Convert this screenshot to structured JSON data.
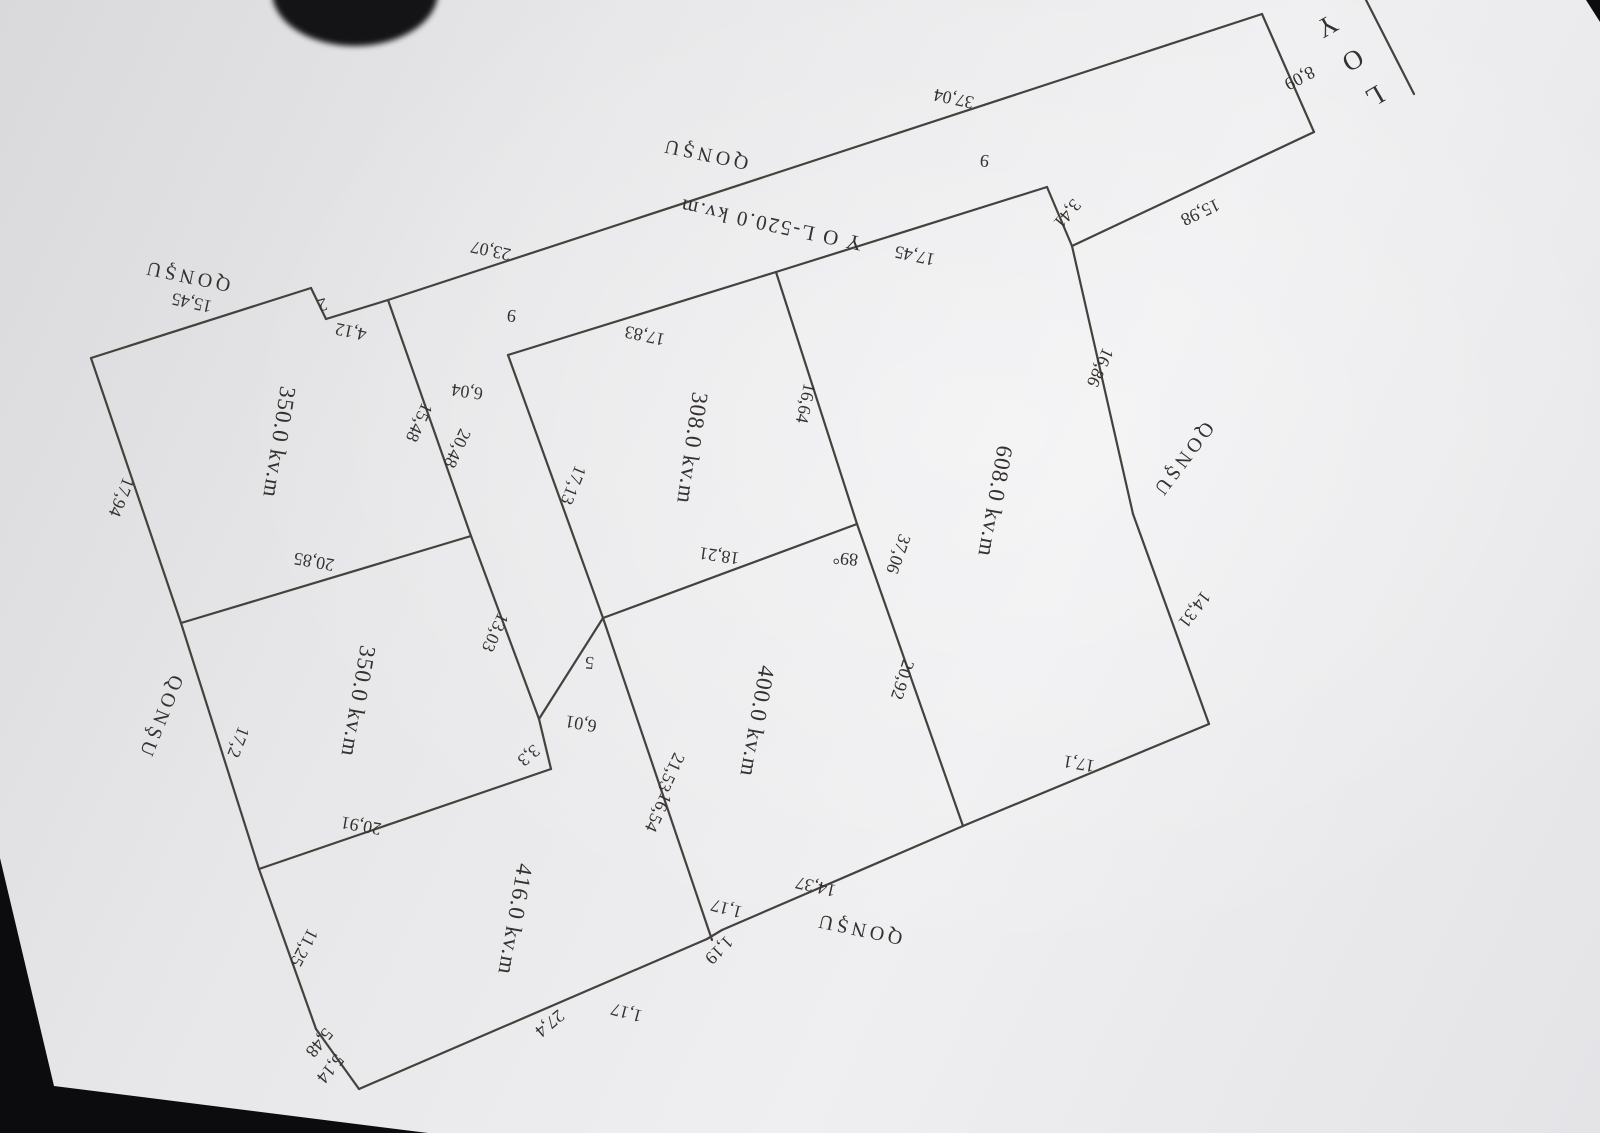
{
  "scene": {
    "background_color": "#0c0c0e",
    "paper_color": "#e7e7e9",
    "line_color": "#45413d",
    "ink_color": "#34312e"
  },
  "plan": {
    "road_strip_label": "Y O L-520.0 kv.m",
    "road_name": "YOL",
    "lines": [
      {
        "x1": 1366,
        "y1": 0,
        "x2": 1414,
        "y2": 94
      },
      {
        "x1": 1262,
        "y1": 14,
        "x2": 1314,
        "y2": 132
      },
      {
        "x1": 1314,
        "y1": 132,
        "x2": 1072,
        "y2": 246
      },
      {
        "x1": 1072,
        "y1": 246,
        "x2": 1047,
        "y2": 187
      },
      {
        "x1": 388,
        "y1": 300,
        "x2": 1262,
        "y2": 14
      },
      {
        "x1": 1047,
        "y1": 187,
        "x2": 776,
        "y2": 272
      },
      {
        "x1": 776,
        "y1": 272,
        "x2": 508,
        "y2": 355
      },
      {
        "x1": 508,
        "y1": 355,
        "x2": 603,
        "y2": 618
      },
      {
        "x1": 776,
        "y1": 272,
        "x2": 857,
        "y2": 524
      },
      {
        "x1": 857,
        "y1": 524,
        "x2": 963,
        "y2": 826
      },
      {
        "x1": 603,
        "y1": 618,
        "x2": 857,
        "y2": 524
      },
      {
        "x1": 1072,
        "y1": 246,
        "x2": 1133,
        "y2": 514
      },
      {
        "x1": 1133,
        "y1": 514,
        "x2": 1209,
        "y2": 724
      },
      {
        "x1": 1209,
        "y1": 724,
        "x2": 963,
        "y2": 826
      },
      {
        "x1": 963,
        "y1": 826,
        "x2": 722,
        "y2": 930
      },
      {
        "x1": 722,
        "y1": 930,
        "x2": 707,
        "y2": 939
      },
      {
        "x1": 707,
        "y1": 939,
        "x2": 359,
        "y2": 1089
      },
      {
        "x1": 359,
        "y1": 1089,
        "x2": 316,
        "y2": 1029
      },
      {
        "x1": 316,
        "y1": 1029,
        "x2": 259,
        "y2": 869
      },
      {
        "x1": 259,
        "y1": 869,
        "x2": 181,
        "y2": 623
      },
      {
        "x1": 181,
        "y1": 623,
        "x2": 91,
        "y2": 358
      },
      {
        "x1": 91,
        "y1": 358,
        "x2": 311,
        "y2": 288
      },
      {
        "x1": 311,
        "y1": 288,
        "x2": 326,
        "y2": 319
      },
      {
        "x1": 326,
        "y1": 319,
        "x2": 388,
        "y2": 300
      },
      {
        "x1": 388,
        "y1": 300,
        "x2": 471,
        "y2": 536
      },
      {
        "x1": 471,
        "y1": 536,
        "x2": 539,
        "y2": 719
      },
      {
        "x1": 539,
        "y1": 719,
        "x2": 551,
        "y2": 769
      },
      {
        "x1": 551,
        "y1": 769,
        "x2": 259,
        "y2": 869
      },
      {
        "x1": 181,
        "y1": 623,
        "x2": 471,
        "y2": 536
      },
      {
        "x1": 603,
        "y1": 618,
        "x2": 539,
        "y2": 719
      },
      {
        "x1": 603,
        "y1": 618,
        "x2": 712,
        "y2": 940
      }
    ],
    "labels": [
      {
        "text": "Y",
        "x": 1320,
        "y": 20,
        "r": 150,
        "c": "rd2"
      },
      {
        "text": "O",
        "x": 1346,
        "y": 54,
        "r": 150,
        "c": "rd2"
      },
      {
        "text": "L",
        "x": 1368,
        "y": 90,
        "r": 150,
        "c": "rd2"
      },
      {
        "text": "8,09",
        "x": 1297,
        "y": 73,
        "r": 152,
        "c": "dim"
      },
      {
        "text": "15,98",
        "x": 1198,
        "y": 207,
        "r": 155,
        "c": "dim"
      },
      {
        "text": "3,41",
        "x": 1063,
        "y": 210,
        "r": 130,
        "c": "dim"
      },
      {
        "text": "37,04",
        "x": 955,
        "y": 93,
        "r": 192,
        "c": "dim"
      },
      {
        "text": "23,07",
        "x": 492,
        "y": 245,
        "r": 192,
        "c": "dim"
      },
      {
        "text": "QONŞU",
        "x": 706,
        "y": 148,
        "r": 192,
        "c": "nb"
      },
      {
        "text": "QONŞU",
        "x": 188,
        "y": 270,
        "r": 192,
        "c": "nb"
      },
      {
        "text": "15,45",
        "x": 193,
        "y": 297,
        "r": 192,
        "c": "dim"
      },
      {
        "text": "QONŞU",
        "x": 155,
        "y": 715,
        "r": 112,
        "c": "nb"
      },
      {
        "text": "QONŞU",
        "x": 1178,
        "y": 456,
        "r": 127,
        "c": "nb"
      },
      {
        "text": "QONŞU",
        "x": 860,
        "y": 923,
        "r": 192,
        "c": "nb"
      },
      {
        "text": "Y O L-520.0 kv.m",
        "x": 772,
        "y": 218,
        "r": 192,
        "c": "road"
      },
      {
        "text": "9",
        "x": 985,
        "y": 155,
        "r": 185,
        "c": "dim"
      },
      {
        "text": "9",
        "x": 512,
        "y": 310,
        "r": 185,
        "c": "dim"
      },
      {
        "text": "17,45",
        "x": 916,
        "y": 250,
        "r": 192,
        "c": "dim"
      },
      {
        "text": "17,83",
        "x": 646,
        "y": 330,
        "r": 192,
        "c": "dim"
      },
      {
        "text": "2",
        "x": 321,
        "y": 299,
        "r": 165,
        "c": "dim"
      },
      {
        "text": "4,12",
        "x": 352,
        "y": 326,
        "r": 192,
        "c": "dim"
      },
      {
        "text": "15,48",
        "x": 414,
        "y": 420,
        "r": 115,
        "c": "dim"
      },
      {
        "text": "20,48",
        "x": 452,
        "y": 446,
        "r": 115,
        "c": "dim"
      },
      {
        "text": "6,04",
        "x": 468,
        "y": 386,
        "r": 188,
        "c": "dim"
      },
      {
        "text": "17,13",
        "x": 568,
        "y": 483,
        "r": 112,
        "c": "dim"
      },
      {
        "text": "16,64",
        "x": 800,
        "y": 402,
        "r": 102,
        "c": "dim"
      },
      {
        "text": "18,21",
        "x": 720,
        "y": 550,
        "r": 188,
        "c": "dim"
      },
      {
        "text": "89°",
        "x": 846,
        "y": 553,
        "r": 185,
        "c": "dim"
      },
      {
        "text": "37,06",
        "x": 893,
        "y": 552,
        "r": 110,
        "c": "dim"
      },
      {
        "text": "20,92",
        "x": 897,
        "y": 678,
        "r": 108,
        "c": "dim"
      },
      {
        "text": "16,86",
        "x": 1095,
        "y": 365,
        "r": 115,
        "c": "dim"
      },
      {
        "text": "14,31",
        "x": 1190,
        "y": 606,
        "r": 128,
        "c": "dim"
      },
      {
        "text": "17,1",
        "x": 1080,
        "y": 758,
        "r": 190,
        "c": "dim"
      },
      {
        "text": "14,37",
        "x": 817,
        "y": 881,
        "r": 193,
        "c": "dim"
      },
      {
        "text": "1,17",
        "x": 728,
        "y": 903,
        "r": 195,
        "c": "dim"
      },
      {
        "text": "1,19",
        "x": 715,
        "y": 946,
        "r": 135,
        "c": "dim"
      },
      {
        "text": "1,17",
        "x": 628,
        "y": 1007,
        "r": 195,
        "c": "dim"
      },
      {
        "text": "21,53",
        "x": 666,
        "y": 770,
        "r": 115,
        "c": "dim"
      },
      {
        "text": "16,54",
        "x": 653,
        "y": 810,
        "r": 115,
        "c": "dim"
      },
      {
        "text": "13,03",
        "x": 490,
        "y": 630,
        "r": 115,
        "c": "dim"
      },
      {
        "text": "5",
        "x": 590,
        "y": 657,
        "r": 185,
        "c": "dim"
      },
      {
        "text": "6,01",
        "x": 582,
        "y": 718,
        "r": 190,
        "c": "dim"
      },
      {
        "text": "3,3",
        "x": 525,
        "y": 751,
        "r": 140,
        "c": "dim"
      },
      {
        "text": "20,85",
        "x": 315,
        "y": 556,
        "r": 190,
        "c": "dim"
      },
      {
        "text": "20,91",
        "x": 362,
        "y": 820,
        "r": 190,
        "c": "dim"
      },
      {
        "text": "17,2",
        "x": 233,
        "y": 740,
        "r": 112,
        "c": "dim"
      },
      {
        "text": "17,94",
        "x": 116,
        "y": 495,
        "r": 112,
        "c": "dim"
      },
      {
        "text": "11,25",
        "x": 299,
        "y": 945,
        "r": 118,
        "c": "dim"
      },
      {
        "text": "27,4",
        "x": 546,
        "y": 1019,
        "r": 140,
        "c": "dim"
      },
      {
        "text": "5,48",
        "x": 315,
        "y": 1039,
        "r": 130,
        "c": "dim"
      },
      {
        "text": "5,14",
        "x": 326,
        "y": 1065,
        "r": 130,
        "c": "dim"
      },
      {
        "text": "350.0 kv.m",
        "x": 272,
        "y": 441,
        "r": 99,
        "c": "area"
      },
      {
        "text": "350.0 kv.m",
        "x": 351,
        "y": 700,
        "r": 100,
        "c": "area"
      },
      {
        "text": "308.0 kv.m",
        "x": 685,
        "y": 447,
        "r": 98,
        "c": "area"
      },
      {
        "text": "608.0 kv.m",
        "x": 988,
        "y": 500,
        "r": 100,
        "c": "area"
      },
      {
        "text": "400.0 kv.m",
        "x": 750,
        "y": 720,
        "r": 100,
        "c": "area"
      },
      {
        "text": "416.0 kv.m",
        "x": 508,
        "y": 918,
        "r": 100,
        "c": "area"
      }
    ]
  }
}
